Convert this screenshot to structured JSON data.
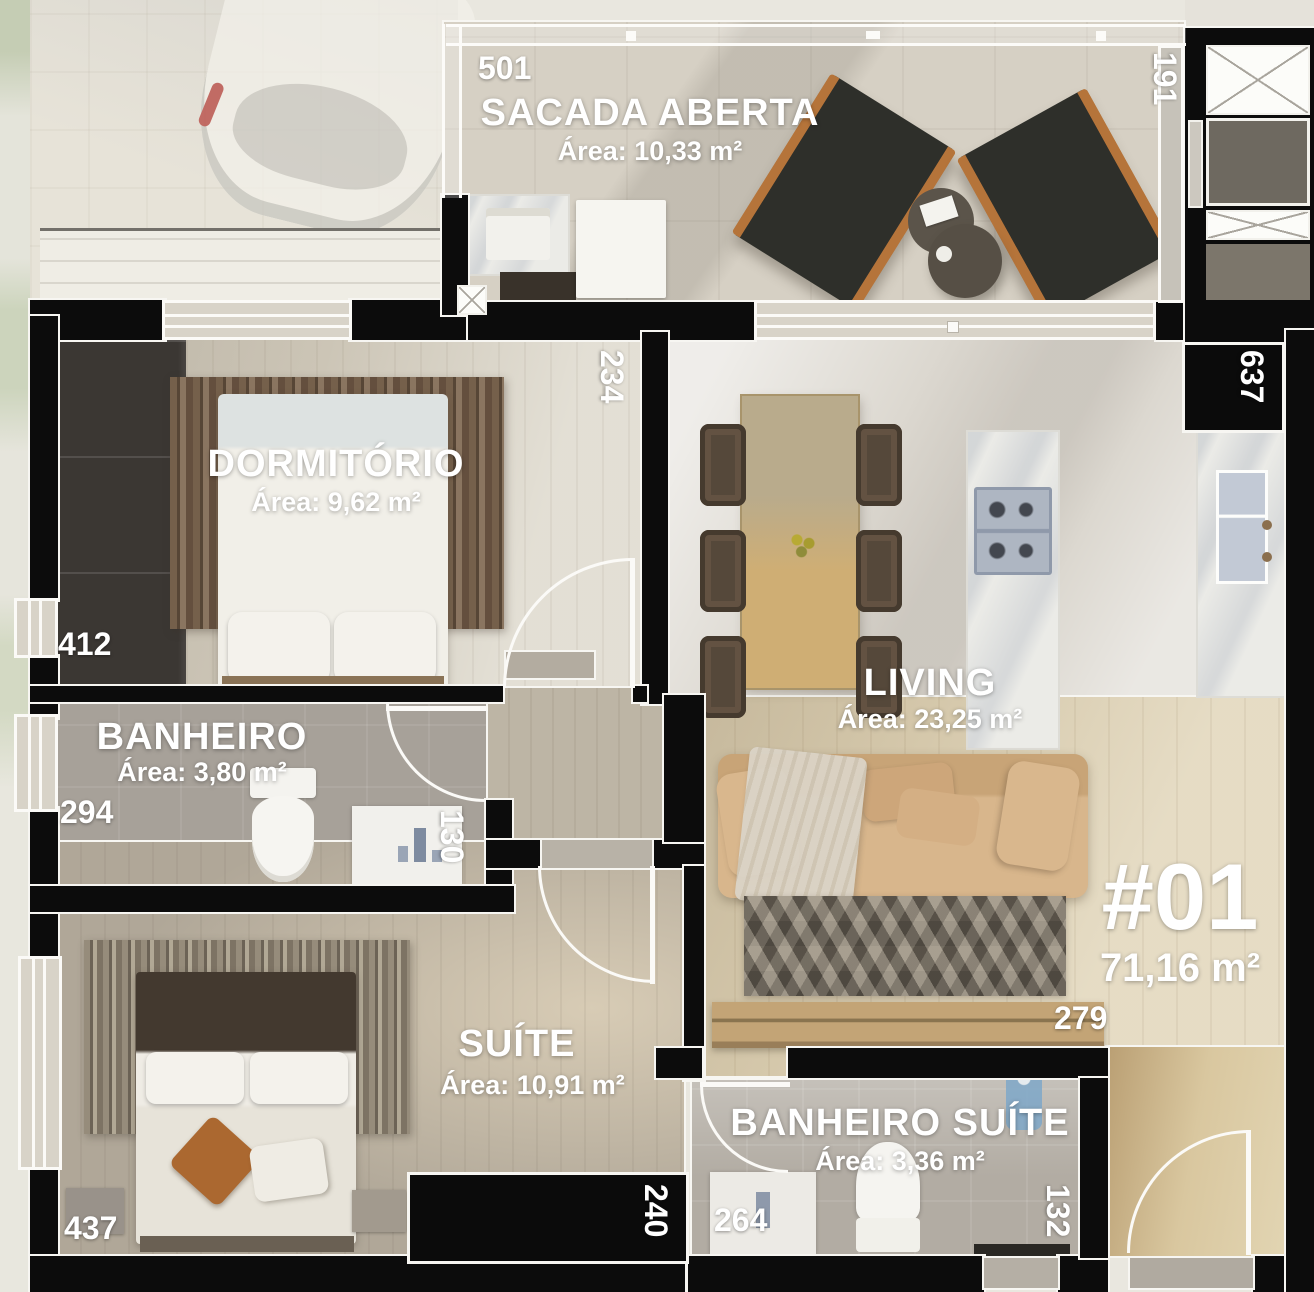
{
  "unit": {
    "number": "#01",
    "area": "71,16 m²"
  },
  "rooms": {
    "sacada": {
      "name": "SACADA ABERTA",
      "area": "Área: 10,33 m²",
      "dim_w": "501",
      "dim_d": "191"
    },
    "dormitorio": {
      "name": "DORMITÓRIO",
      "area": "Área: 9,62 m²",
      "dim_w": "412",
      "dim_d": "234"
    },
    "living": {
      "name": "LIVING",
      "area": "Área: 23,25 m²",
      "dim_w": "279",
      "dim_d": "637"
    },
    "banheiro": {
      "name": "BANHEIRO",
      "area": "Área: 3,80 m²",
      "dim_w": "294",
      "dim_d": "130"
    },
    "suite": {
      "name": "SUÍTE",
      "area": "Área: 10,91 m²",
      "dim_w": "437",
      "dim_d": "240"
    },
    "banheiro_suite": {
      "name": "BANHEIRO SUÍTE",
      "area": "Área: 3,36 m²",
      "dim_w": "264",
      "dim_d": "132"
    }
  },
  "colors": {
    "wall": "#0c0c0c",
    "outline": "#fafaf7",
    "label": "#ffffff",
    "wood": "#d5c8ab",
    "tan_sofa": "#d3b086"
  }
}
